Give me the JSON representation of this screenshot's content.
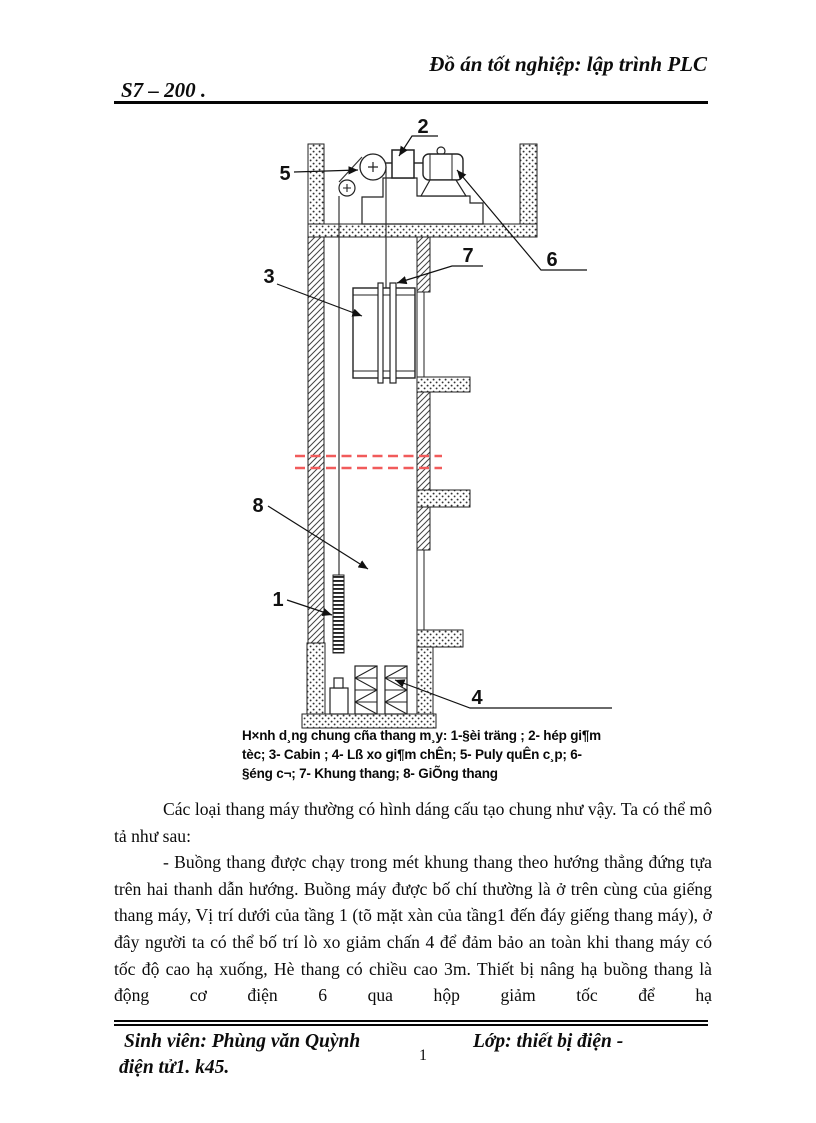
{
  "header": {
    "title": "Đồ án tốt nghiệp: lập trình PLC",
    "subtitle": "S7 – 200 ."
  },
  "figure": {
    "labels": [
      {
        "text": "2"
      },
      {
        "text": "5"
      },
      {
        "text": "6"
      },
      {
        "text": "7"
      },
      {
        "text": "3"
      },
      {
        "text": "8"
      },
      {
        "text": "1"
      },
      {
        "text": "4"
      }
    ],
    "caption_lines": [
      "H×nh d¸ng chung cña thang m¸y:  1-§èi träng ; 2- hép gi¶m",
      "tèc; 3- Cabin ; 4- Lß xo gi¶m chÊn; 5- Puly quÊn c¸p; 6-",
      "§éng c¬; 7- Khung thang; 8- GiÕng thang"
    ],
    "colors": {
      "break_line": "#f15b5b",
      "ink": "#1a1a1a"
    }
  },
  "body": {
    "paragraph_1": "Các loại thang máy thường có hình dáng cấu tạo chung như vậy. Ta có thể mô tả như sau:",
    "paragraph_2": "- Buồng thang được chạy trong mét khung thang theo hướng thẳng đứng tựa trên hai thanh dẫn hướng. Buồng máy được bố chí thường là ở trên cùng của giếng thang máy, Vị trí dưới của tầng 1 (tõ mặt xàn của tầng1 đến đáy giếng thang máy), ở đây người ta có thể bố trí lò xo giảm chấn 4 để đảm bảo an toàn khi thang máy có tốc độ cao hạ xuống, Hè thang có chiều cao 3m. Thiết bị nâng hạ buồng thang là động cơ điện 6 qua hộp giảm tốc để hạ"
  },
  "footer": {
    "student": "Sinh viên: Phùng văn Quỳnh",
    "class_line1": "Lớp: thiết bị điện -",
    "class_line2": "điện tử1. k45.",
    "page_number": "1"
  }
}
